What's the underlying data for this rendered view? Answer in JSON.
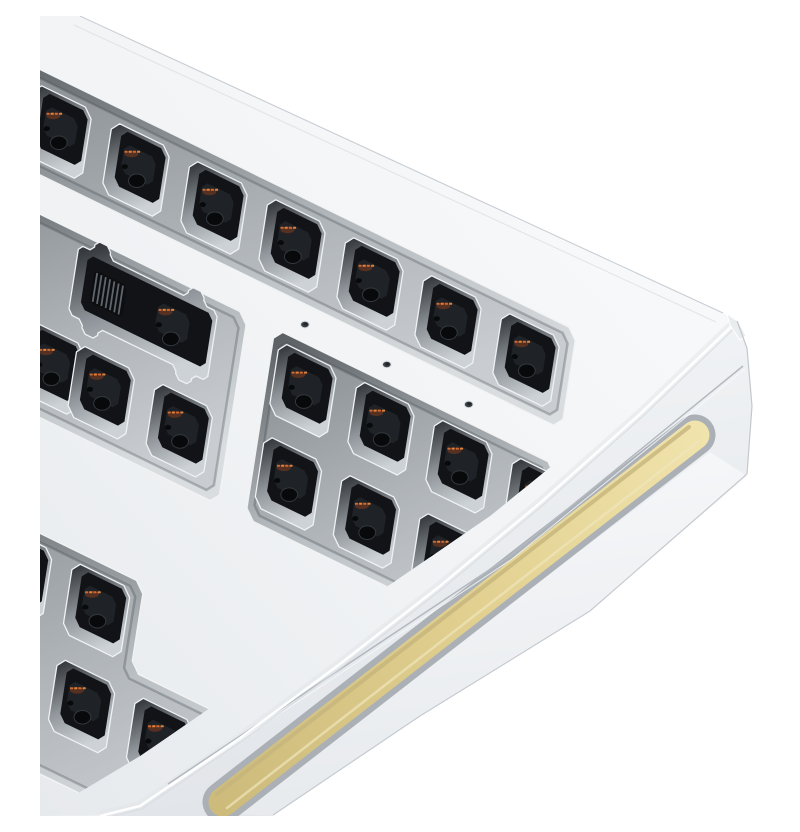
{
  "scene": {
    "title": "White aluminium barebones mechanical keyboard kit, corner close-up render",
    "background": "#ffffff",
    "object": "keyboard-case",
    "style": "3d-product-render",
    "visible_parts": [
      "case top surface",
      "switch plate apertures",
      "empty hot-swap switch cutouts",
      "2u stabilizer cutout with ribbon connector",
      "plate screw holes",
      "side face",
      "gold side-glow accent strip"
    ]
  },
  "palette": {
    "background": "#ffffff",
    "case_white_hi": "#fbfcfd",
    "case_white": "#f1f3f5",
    "case_white_lo": "#e7eaed",
    "bezel_wall_dark": "#54595e",
    "bezel_wall_light": "#d9dde0",
    "plate_gray_dark": "#868c91",
    "plate_gray": "#aeb3b7",
    "plate_gray_light": "#c9cdd1",
    "cutout_wall_dark": "#26292d",
    "cutout_wall_light": "#cdd2d6",
    "cutout_rim": "#eef2f4",
    "hole_black": "#111316",
    "socket_black": "#1f2327",
    "deep_hole": "#08090a",
    "contact_orange": "#cd6a32",
    "contact_glow": "#843d1c",
    "accent_gold_hi": "#f0e3ac",
    "accent_gold": "#e2d191",
    "accent_gold_lo": "#cdbb7b",
    "gold_top_shade": "#c6b57c",
    "gold_frame": "#aab0b6",
    "lip_gray": "#7c838a",
    "seam_gray": "#b3b9bf",
    "edge_gray": "#c9ced3",
    "screw_hole": "#3a3e42"
  },
  "projection": {
    "origin": [
      18,
      116
    ],
    "u_axis": [
      78,
      38
    ],
    "v_axis": [
      -15,
      96
    ],
    "pitch_px": 87
  },
  "case_geometry": {
    "silhouette": "M40,0 L683,297 Q697,304 702,316 L707,332 L712,390 L707,458 L550,595 L380,700 L233,799 L0,800 L0,0 Z",
    "top_edge": [
      [
        40,
        0
      ],
      [
        683,
        297
      ]
    ],
    "top_edge_inner": [
      [
        34,
        9
      ],
      [
        676,
        306
      ]
    ],
    "right_edge": [
      [
        697,
        305
      ],
      [
        707,
        332
      ],
      [
        712,
        390
      ],
      [
        707,
        458
      ]
    ],
    "bottom_edge": [
      [
        707,
        458
      ],
      [
        550,
        595
      ],
      [
        380,
        700
      ],
      [
        233,
        799
      ]
    ],
    "arris": [
      [
        697,
        305
      ],
      [
        600,
        398
      ],
      [
        500,
        487
      ],
      [
        400,
        570
      ],
      [
        300,
        648
      ],
      [
        200,
        722
      ],
      [
        100,
        790
      ],
      [
        60,
        800
      ]
    ],
    "seam": [
      [
        703,
        350
      ],
      [
        470,
        540
      ],
      [
        128,
        768
      ]
    ],
    "corner_facet": [
      [
        687,
        298
      ],
      [
        699,
        306
      ],
      [
        706,
        320
      ],
      [
        700,
        324
      ],
      [
        690,
        309
      ]
    ],
    "lower_band": [
      [
        670,
        436
      ],
      [
        196,
        798
      ],
      [
        233,
        800
      ],
      [
        380,
        700
      ],
      [
        550,
        595
      ],
      [
        707,
        460
      ]
    ],
    "gold_centerline": [
      [
        655,
        419
      ],
      [
        183,
        786
      ]
    ],
    "gold_width": 29,
    "gold_frame_width": 41,
    "gold_shade_offset": [
      -6,
      -8
    ],
    "gold_lip_offset": [
      8,
      11
    ],
    "bezel_clip": [
      [
        0,
        0
      ],
      [
        800,
        0
      ],
      [
        800,
        217
      ],
      [
        660,
        330
      ],
      [
        450,
        500
      ],
      [
        100,
        740
      ],
      [
        0,
        800
      ]
    ]
  },
  "apertures": [
    {
      "id": "top-row",
      "uv": [
        [
          -1.3,
          -0.52
        ],
        [
          6.55,
          -0.52
        ],
        [
          6.55,
          0.5
        ],
        [
          -1.3,
          0.5
        ]
      ]
    },
    {
      "id": "mid-left",
      "uv": [
        [
          -1.3,
          0.88
        ],
        [
          2.6,
          0.88
        ],
        [
          2.6,
          2.85
        ],
        [
          -1.3,
          2.85
        ]
      ]
    },
    {
      "id": "mid-right",
      "uv": [
        [
          2.95,
          0.88
        ],
        [
          6.55,
          0.88
        ],
        [
          6.55,
          2.85
        ],
        [
          2.95,
          2.85
        ]
      ]
    },
    {
      "id": "bottom-left",
      "uv": [
        [
          -1.3,
          3.97
        ],
        [
          1.87,
          3.97
        ],
        [
          1.87,
          4.87
        ],
        [
          3.47,
          4.87
        ],
        [
          3.47,
          6.3
        ],
        [
          -1.3,
          6.3
        ]
      ]
    },
    {
      "id": "bottom-right",
      "uv": [
        [
          3.93,
          3.97
        ],
        [
          6.3,
          3.97
        ],
        [
          6.3,
          5.0
        ],
        [
          3.93,
          5.0
        ]
      ]
    }
  ],
  "cutouts": [
    {
      "u": 0,
      "v": 0
    },
    {
      "u": 1,
      "v": 0
    },
    {
      "u": 2,
      "v": 0
    },
    {
      "u": 3,
      "v": 0
    },
    {
      "u": 4,
      "v": 0
    },
    {
      "u": 5,
      "v": 0
    },
    {
      "u": 6,
      "v": 0
    },
    {
      "u": 3.4,
      "v": 1.35
    },
    {
      "u": 4.4,
      "v": 1.35
    },
    {
      "u": 5.4,
      "v": 1.35
    },
    {
      "u": 6.4,
      "v": 1.35
    },
    {
      "u": 0.35,
      "v": 2.32
    },
    {
      "u": 1,
      "v": 2.32
    },
    {
      "u": 2,
      "v": 2.32
    },
    {
      "u": 3.4,
      "v": 2.32
    },
    {
      "u": 4.4,
      "v": 2.32
    },
    {
      "u": 5.4,
      "v": 2.32
    },
    {
      "u": 6.4,
      "v": 2.32
    },
    {
      "u": 0.35,
      "v": 4.45
    },
    {
      "u": 1.35,
      "v": 4.45
    },
    {
      "u": 0.35,
      "v": 5.45
    },
    {
      "u": 1.35,
      "v": 5.45
    },
    {
      "u": 2.35,
      "v": 5.45
    },
    {
      "u": 4.43,
      "v": 4.45
    }
  ],
  "cutout_size": 0.74,
  "stabilizer_cutout": {
    "u": 1.35,
    "v": 1.35,
    "w": 1.78,
    "h": 0.72,
    "notch_offset": 0.6,
    "notch_w": 0.2,
    "notch_d": 0.12,
    "ribbon_stripes": 7
  },
  "screw_holes": [
    {
      "u": 3.3,
      "v": 0.7
    },
    {
      "u": 4.35,
      "v": 0.7
    },
    {
      "u": 5.4,
      "v": 0.7
    }
  ]
}
